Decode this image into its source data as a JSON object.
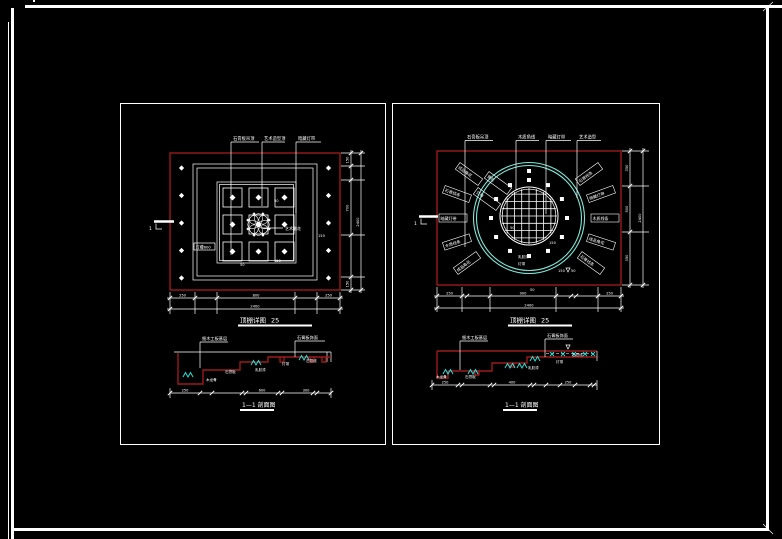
{
  "canvas": {
    "bg": "#000000"
  },
  "colors": {
    "white": "#ffffff",
    "red": "#9b1b1b",
    "cyan": "#7de8da",
    "cyan_bright": "#2bdfd8"
  },
  "left_plan": {
    "title": "顶棚详图",
    "title_scale": "25",
    "leaders": [
      "石膏板吊顶",
      "艺术造型顶",
      "暗藏灯带"
    ],
    "ornament_label": "艺术雕花",
    "frame_label": "灯槽600",
    "marker": "1",
    "small_texts": {
      "a": "50",
      "b": "150",
      "c": "50",
      "d": "150"
    },
    "dims_right": [
      "150",
      "700",
      "150"
    ],
    "dims_right_total": "2400",
    "dims_bottom": [
      "250",
      "800",
      "250"
    ],
    "dims_bottom_total": "2400"
  },
  "right_plan": {
    "title": "顶棚详图",
    "title_scale": "25",
    "leaders": [
      "石膏板吊顶",
      "木质角线",
      "暗藏灯带",
      "艺术造型"
    ],
    "radial_labels": [
      "成品角花",
      "石膏线条",
      "暗藏灯带",
      "木质线条",
      "成品角花",
      "石膏线条",
      "暗藏灯带",
      "木质线条",
      "成品角花",
      "石膏线条",
      "角花",
      "灯带"
    ],
    "marker": "1",
    "small_texts": {
      "a": "50",
      "b": "150",
      "c": "50",
      "d": "150",
      "e": "乳胶漆",
      "f": "灯带",
      "g": "50"
    },
    "dims_right": [
      "350",
      "500",
      "350"
    ],
    "dims_right_total": "2400",
    "dims_bottom": [
      "250",
      "900",
      "250"
    ],
    "dims_bottom_total": "2400"
  },
  "left_section": {
    "title": "1—1 剖面图",
    "leaders": [
      "细木工板基层",
      "石膏板饰面"
    ],
    "labels": [
      "木龙骨",
      "石膏板",
      "乳胶漆",
      "灯带",
      "石膏线"
    ],
    "dims": [
      "250",
      "600",
      "300"
    ]
  },
  "right_section": {
    "title": "1—1 剖面图",
    "leaders": [
      "细木工板基层",
      "石膏板饰面"
    ],
    "labels": [
      "木龙骨",
      "石膏板",
      "乳胶漆",
      "灯带",
      "石膏线"
    ],
    "dims": [
      "250",
      "400",
      "250"
    ]
  }
}
